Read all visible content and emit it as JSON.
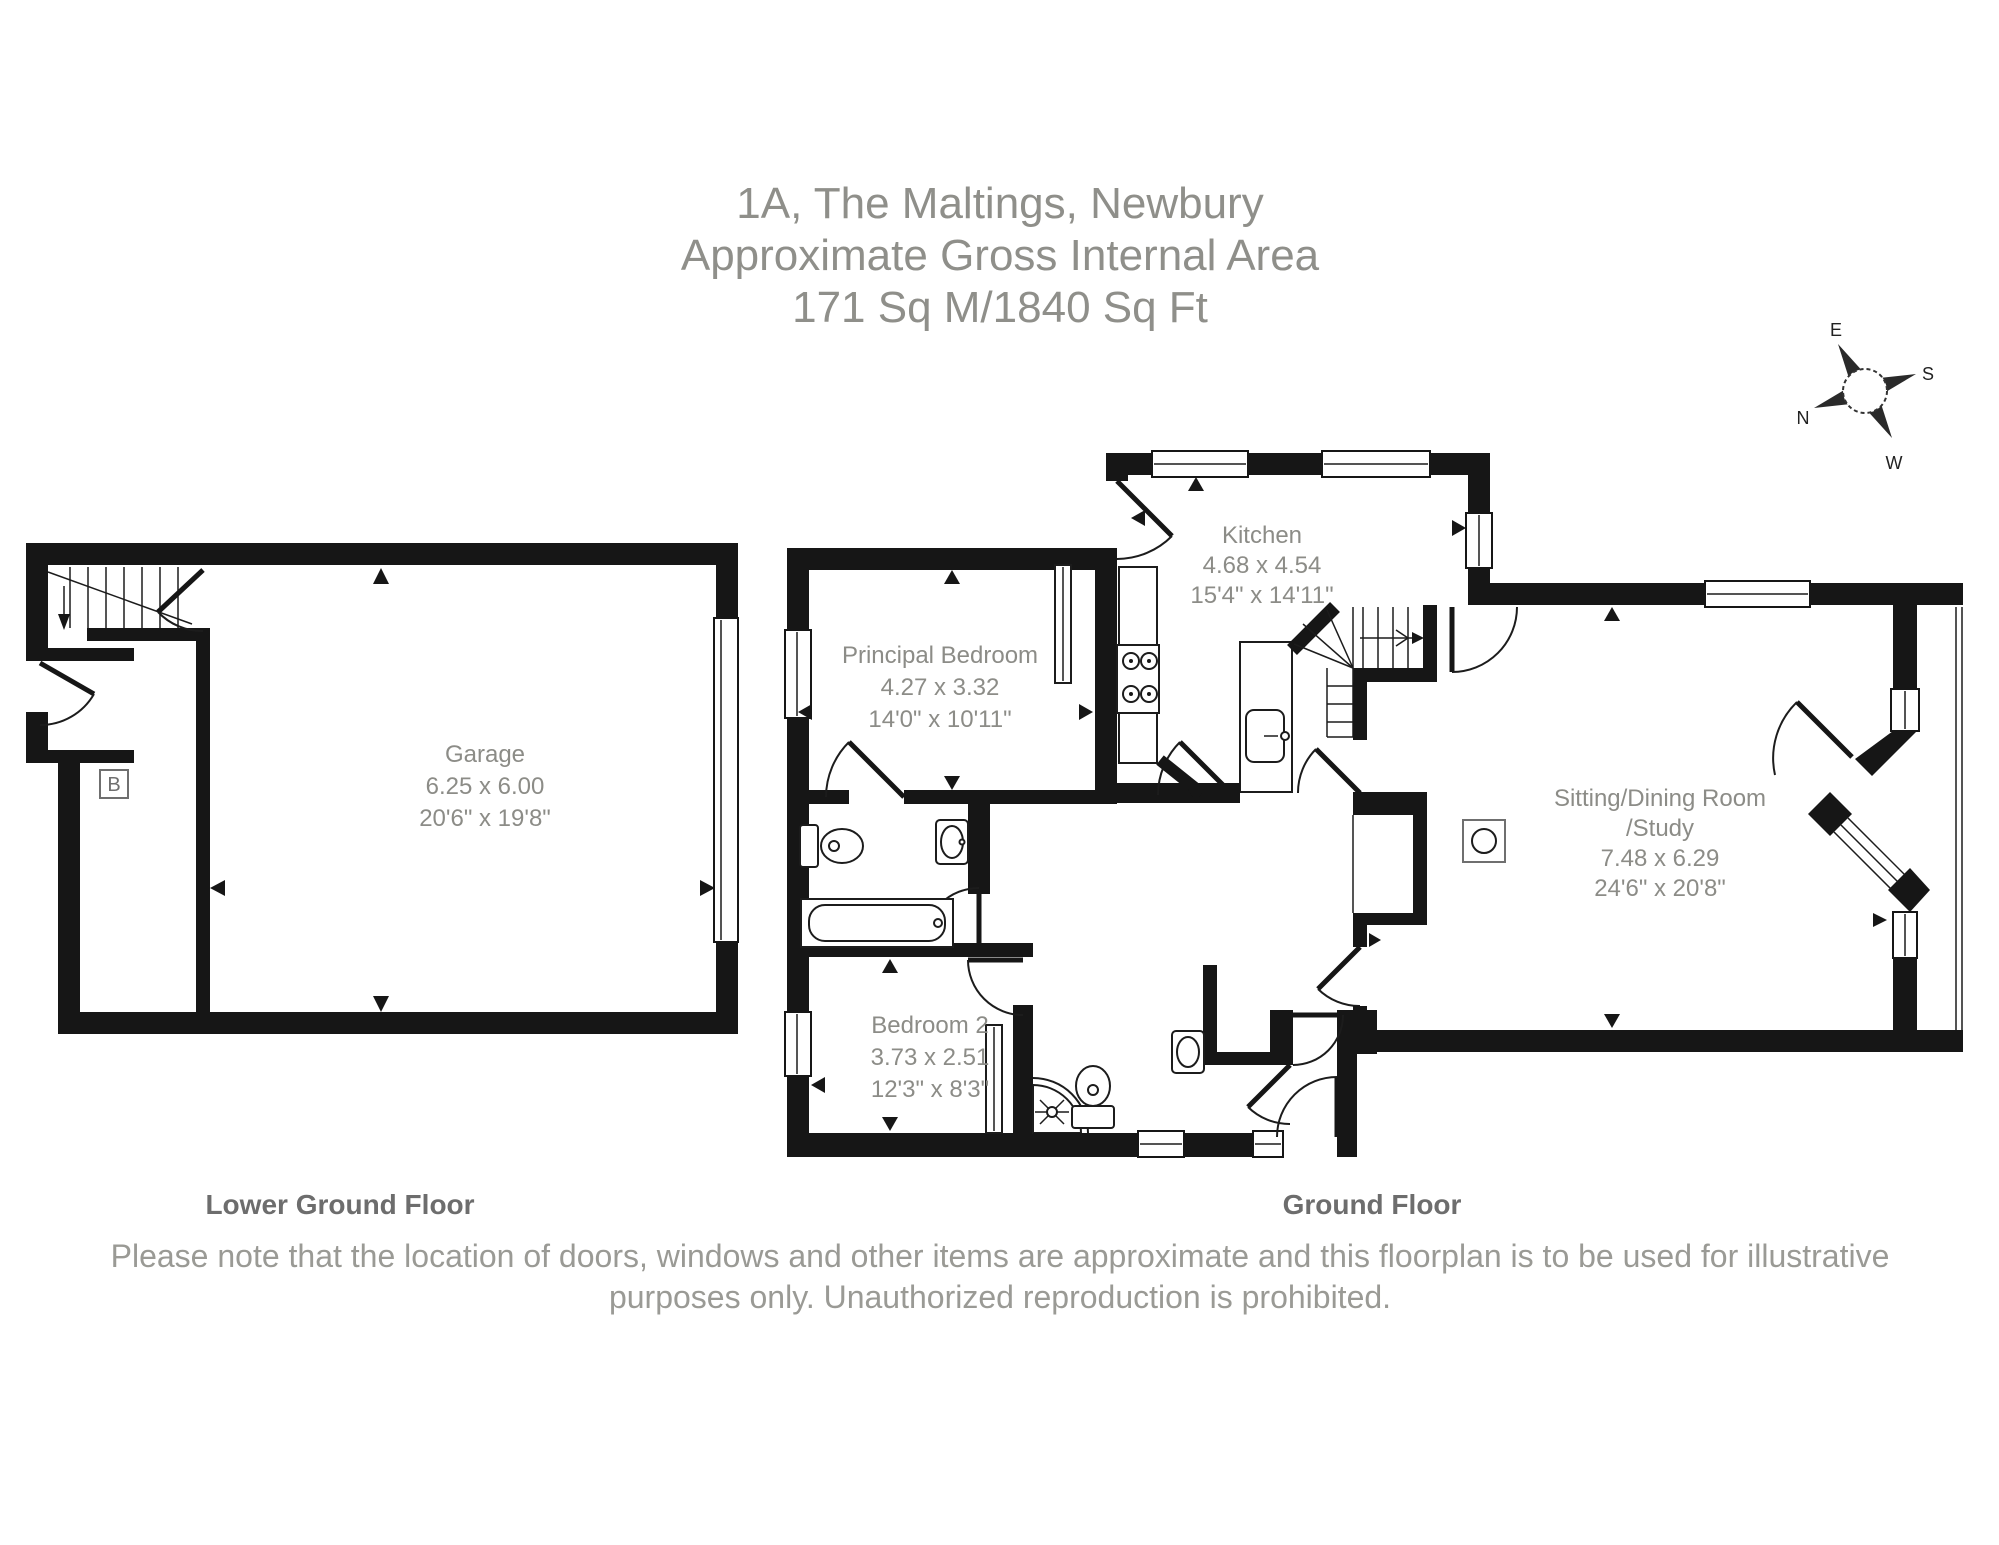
{
  "title": {
    "line1": "1A, The Maltings, Newbury",
    "line2": "Approximate Gross Internal Area",
    "line3": "171 Sq M/1840 Sq Ft"
  },
  "compass": {
    "n": "N",
    "e": "E",
    "s": "S",
    "w": "W"
  },
  "floors": {
    "lower_ground": {
      "label": "Lower Ground Floor"
    },
    "ground": {
      "label": "Ground Floor"
    }
  },
  "rooms": {
    "garage": {
      "name": "Garage",
      "metric": "6.25 x 6.00",
      "imperial": "20'6\" x 19'8\""
    },
    "kitchen": {
      "name": "Kitchen",
      "metric": "4.68 x 4.54",
      "imperial": "15'4\" x 14'11\""
    },
    "principal_bedroom": {
      "name": "Principal Bedroom",
      "metric": "4.27 x 3.32",
      "imperial": "14'0\" x 10'11\""
    },
    "sitting": {
      "name": "Sitting/Dining Room",
      "name2": "/Study",
      "metric": "7.48 x 6.29",
      "imperial": "24'6\" x 20'8\""
    },
    "bedroom2": {
      "name": "Bedroom 2",
      "metric": "3.73 x 2.51",
      "imperial": "12'3\" x 8'3\""
    }
  },
  "annotations": {
    "boiler": "B"
  },
  "disclaimer": {
    "line1": "Please note that the location of doors, windows and other items are approximate and this floorplan is to be used for illustrative",
    "line2": "purposes only. Unauthorized reproduction is prohibited."
  },
  "colors": {
    "wall": "#161616",
    "text": "#8c8c87",
    "caption": "#6d6d6d"
  }
}
